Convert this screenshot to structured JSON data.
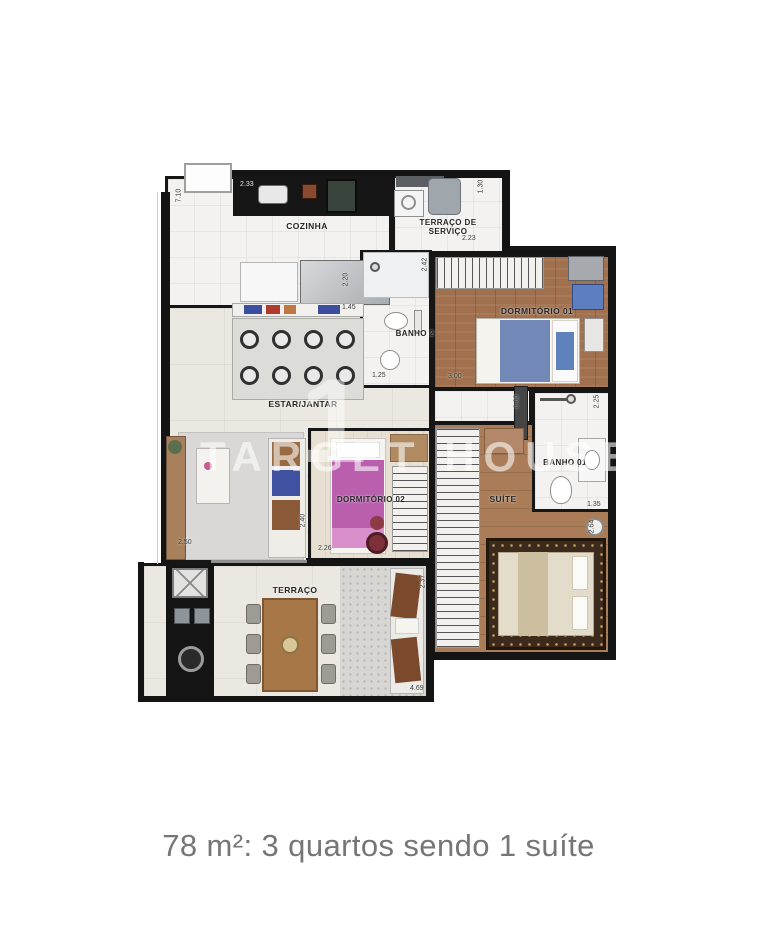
{
  "caption": "78 m²: 3 quartos sendo 1 suíte",
  "watermark": {
    "digit": "1",
    "text": "TARGET HOUSE"
  },
  "rooms": {
    "cozinha": {
      "label": "COZINHA"
    },
    "terraco_servico": {
      "label": "TERRAÇO DE SERVIÇO"
    },
    "banho2": {
      "label": "BANHO 2"
    },
    "dormitorio1": {
      "label": "DORMITÓRIO 01"
    },
    "estar_jantar": {
      "label": "ESTAR/JANTAR"
    },
    "dormitorio2": {
      "label": "DORMITÓRIO 02"
    },
    "banho1": {
      "label": "BANHO 01"
    },
    "suite": {
      "label": "SUÍTE"
    },
    "terraco": {
      "label": "TERRAÇO"
    }
  },
  "dimensions": {
    "total_left": "7.10",
    "cozinha_top": "2.33",
    "servico_right": "1.30",
    "servico_bottom": "2.23",
    "cozinha_counter": "2.20",
    "dorm1_left": "2.42",
    "estar_top": "1.45",
    "banho2_bottom": "1.25",
    "dorm1_bottom": "3.00",
    "hall_width": "0.80",
    "banho1_right": "2.25",
    "banho1_bottom": "1.35",
    "suite_right": "2.64",
    "estar_left": "2.50",
    "dorm2_bottom": "2.26",
    "dorm2_left": "2.40",
    "terraco_right": "2.37",
    "terraco_bottom": "4.69"
  },
  "colors": {
    "wall": "#141414",
    "wood_floor": "#a1714f",
    "bed_blue": "#7289b8",
    "bed_pink": "#b95fae",
    "suite_rug": "#3c2b1d",
    "caption_gray": "#767676"
  }
}
